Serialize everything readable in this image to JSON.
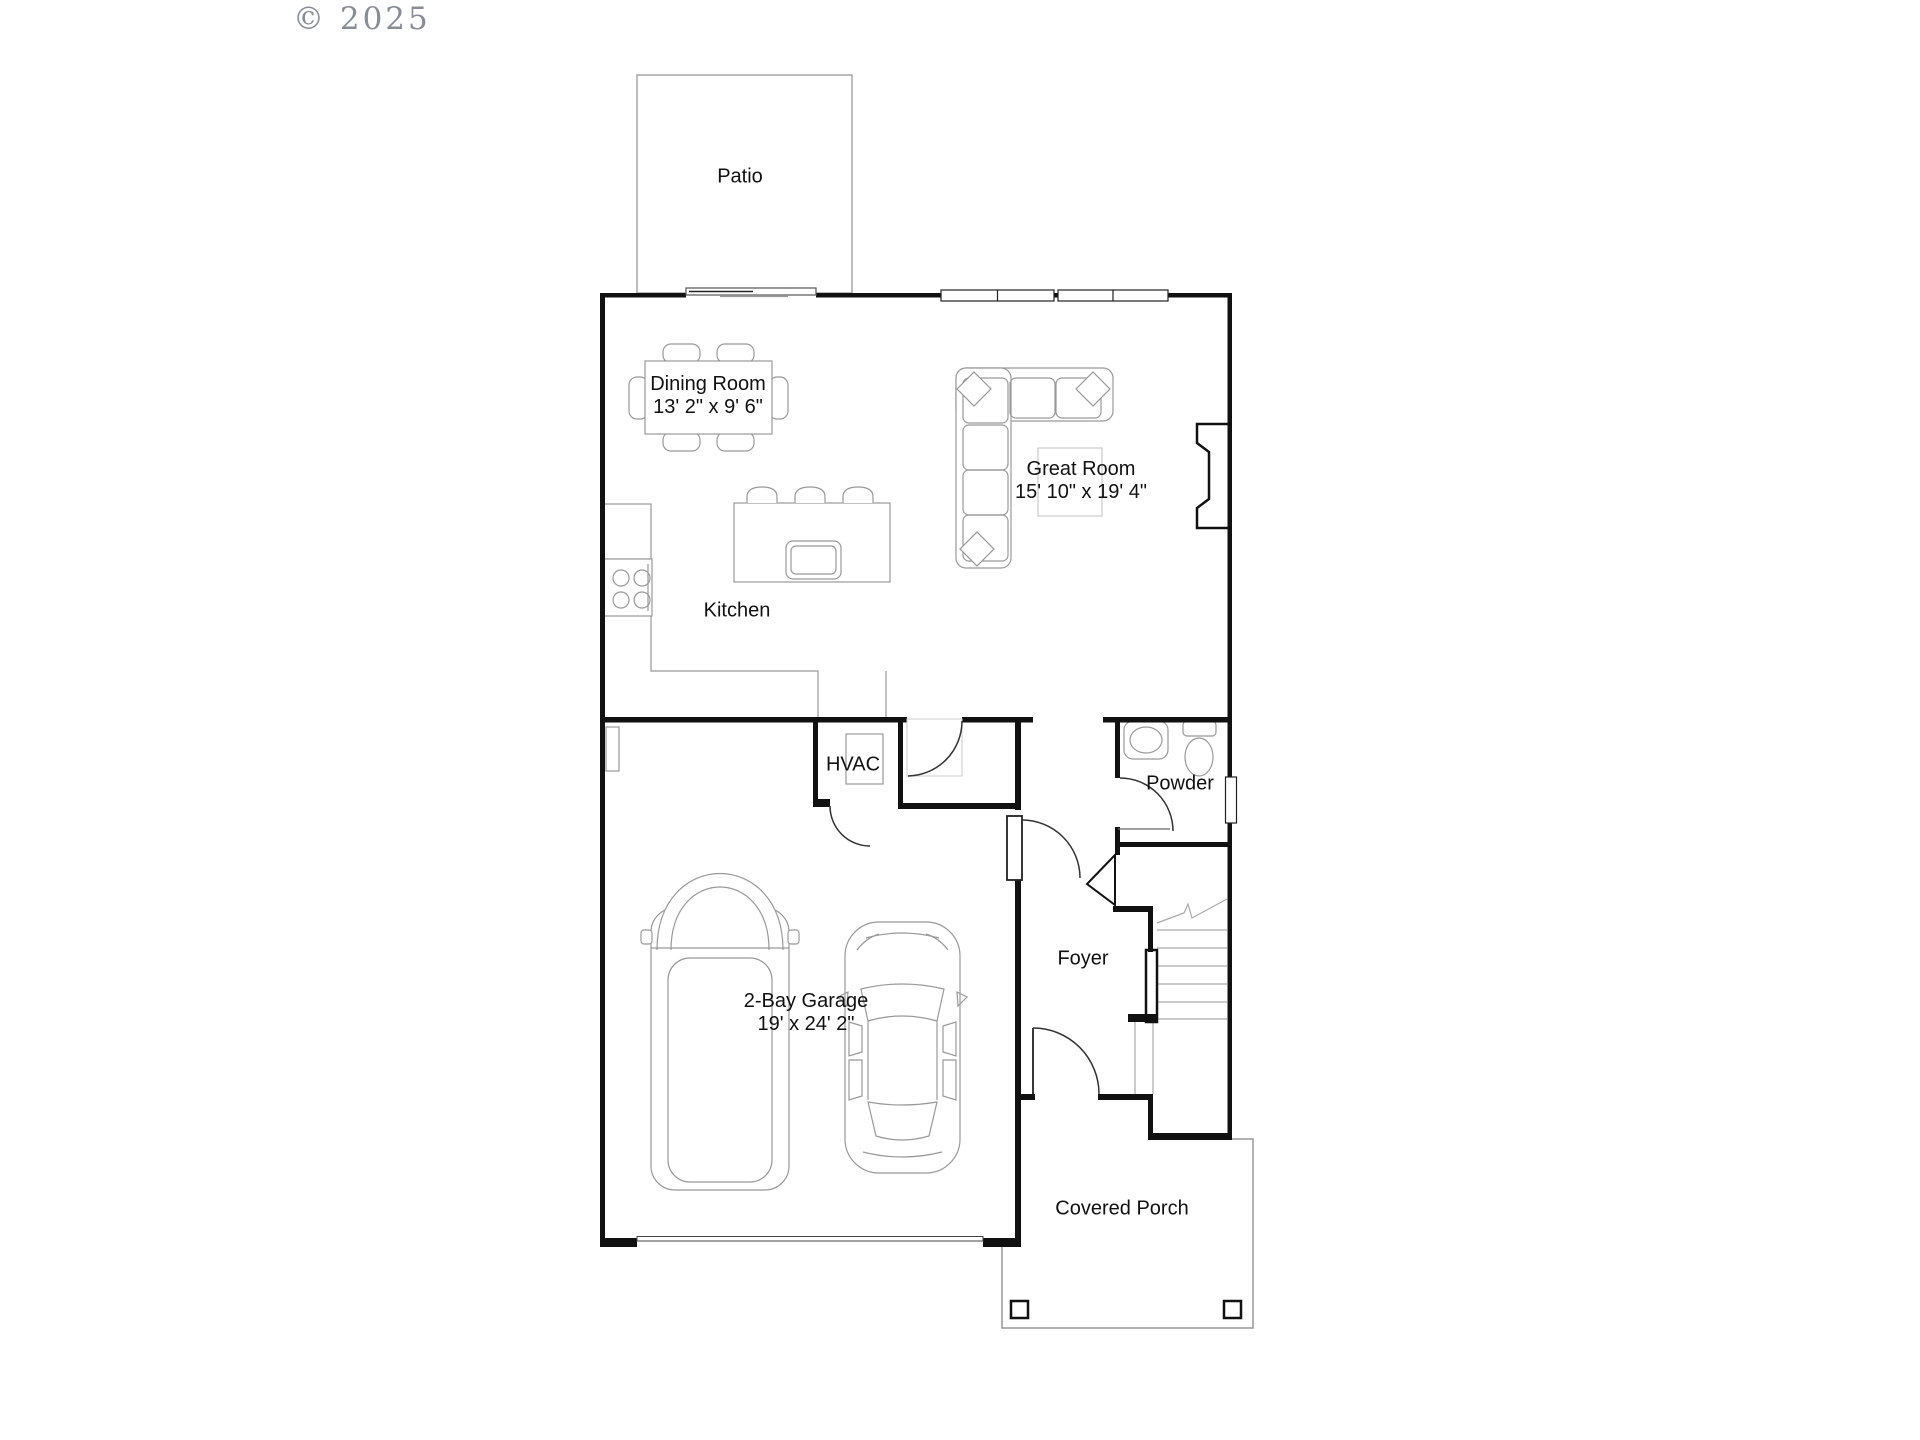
{
  "watermark": {
    "text": "© 2025"
  },
  "rooms": {
    "patio": {
      "name": "Patio"
    },
    "dining_room": {
      "name": "Dining Room",
      "dimensions": "13' 2\" x 9' 6\""
    },
    "great_room": {
      "name": "Great Room",
      "dimensions": "15' 10\" x 19' 4\""
    },
    "kitchen": {
      "name": "Kitchen"
    },
    "hvac": {
      "name": "HVAC"
    },
    "powder": {
      "name": "Powder"
    },
    "foyer": {
      "name": "Foyer"
    },
    "garage": {
      "name": "2-Bay Garage",
      "dimensions": "19' x 24' 2\""
    },
    "covered_porch": {
      "name": "Covered Porch"
    }
  },
  "colors": {
    "wall": "#111111",
    "furniture_line": "#999999",
    "label_text": "#111111",
    "watermark_text": "#878c95",
    "background": "#ffffff"
  }
}
